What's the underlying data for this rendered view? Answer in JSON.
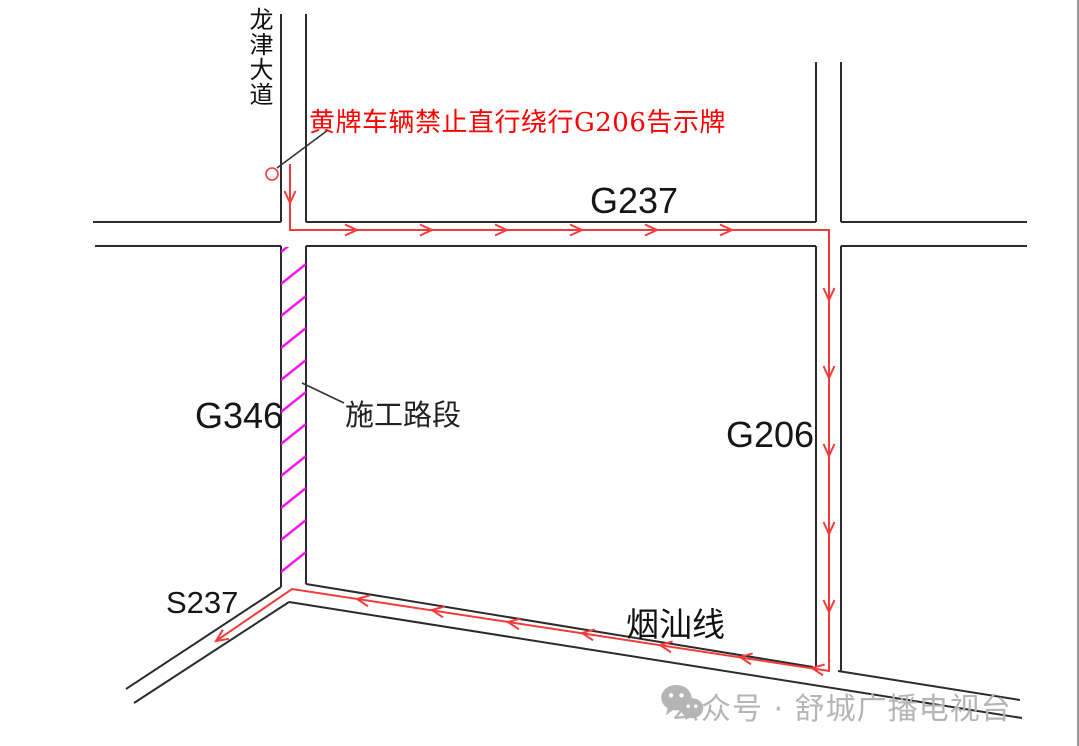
{
  "colors": {
    "road_line": "#2b2b2b",
    "route_red": "#f43b3b",
    "notice_red": "#ff0000",
    "construction_magenta": "#ff00ff",
    "watermark_gray": "#b5b5b5",
    "page_border": "#9a9a9a"
  },
  "labels": {
    "longjin_avenue": "龙津大道",
    "notice": "黄牌车辆禁止直行绕行G206告示牌",
    "g237": "G237",
    "g346": "G346",
    "construction_section": "施工路段",
    "g206": "G206",
    "yanshan_line": "烟汕线",
    "s237": "S237"
  },
  "watermark": {
    "source": "公众号 · 舒城广播电视台",
    "icon": "wechat-logo"
  },
  "diagram": {
    "description": "Detour route for yellow-plate vehicles: down Longjin Avenue, east on G237, south on G206, west on Yanshan Line to S237, bypassing construction on G346",
    "route": {
      "points": [
        [
          290,
          164
        ],
        [
          290,
          230
        ],
        [
          829,
          230
        ],
        [
          829,
          671
        ],
        [
          292,
          589
        ],
        [
          216,
          641
        ]
      ],
      "arrowheads": [
        [
          290,
          203,
          90
        ],
        [
          357,
          230,
          0
        ],
        [
          432,
          230,
          0
        ],
        [
          507,
          230,
          0
        ],
        [
          582,
          230,
          0
        ],
        [
          657,
          230,
          0
        ],
        [
          732,
          230,
          0
        ],
        [
          829,
          300,
          90
        ],
        [
          829,
          378,
          90
        ],
        [
          829,
          456,
          90
        ],
        [
          829,
          534,
          90
        ],
        [
          829,
          612,
          90
        ],
        [
          812,
          668,
          189
        ],
        [
          740,
          657,
          189
        ],
        [
          660,
          645,
          189
        ],
        [
          582,
          633,
          189
        ],
        [
          508,
          622,
          189
        ],
        [
          432,
          610,
          189
        ],
        [
          357,
          599,
          189
        ],
        [
          216,
          641,
          146
        ]
      ],
      "start_marker_circle": [
        272,
        174,
        6
      ]
    },
    "hatch": {
      "x1": 281,
      "x2": 306,
      "y_start": 252,
      "y_end": 608,
      "step": 32,
      "rise": 20
    }
  }
}
